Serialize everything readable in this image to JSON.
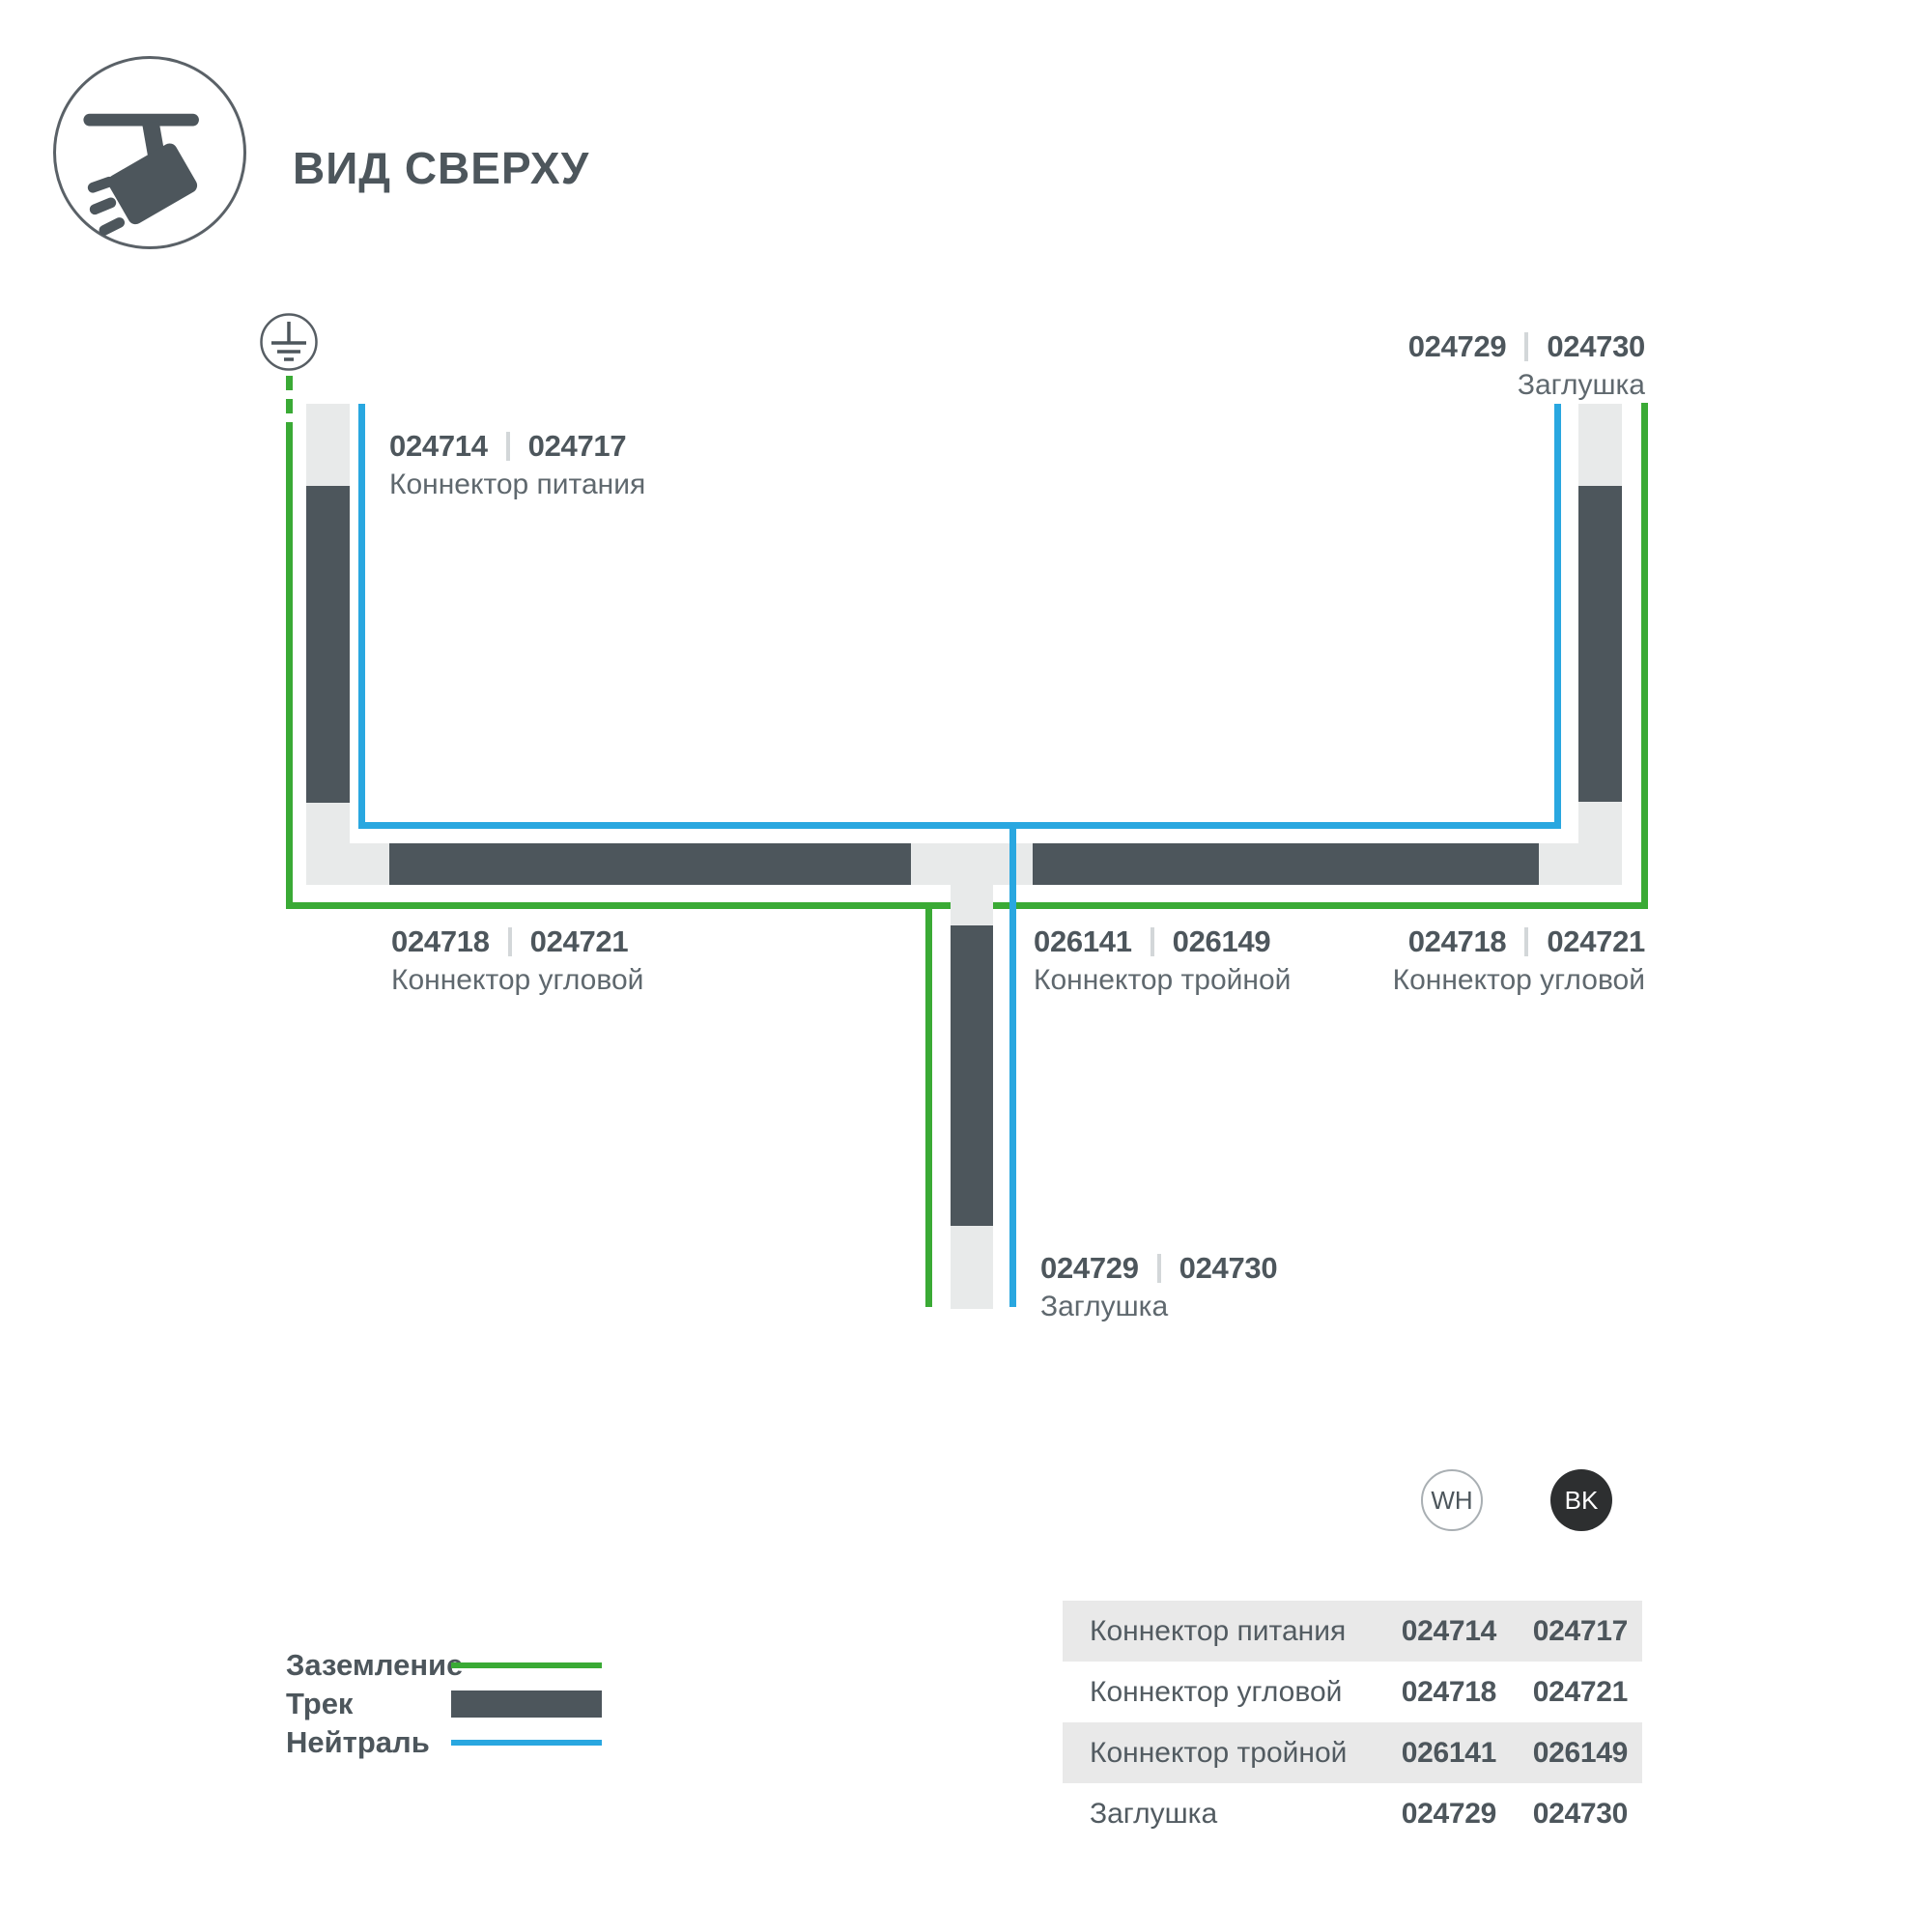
{
  "header": {
    "title": "ВИД СВЕРХУ",
    "icon": "track-spotlight-icon"
  },
  "colors": {
    "ground_green": "#3aaa35",
    "neutral_blue": "#29a7e0",
    "track_dark": "#4d565c",
    "track_light": "#e8eaea",
    "table_row_band": "#e9e9e9"
  },
  "diagram": {
    "ground_symbol_icon": "earth-ground-icon",
    "labels": {
      "power": {
        "code_a": "024714",
        "code_b": "024717",
        "name": "Коннектор питания"
      },
      "endcap_top": {
        "code_a": "024729",
        "code_b": "024730",
        "name": "Заглушка"
      },
      "corner_left": {
        "code_a": "024718",
        "code_b": "024721",
        "name": "Коннектор угловой"
      },
      "triple": {
        "code_a": "026141",
        "code_b": "026149",
        "name": "Коннектор тройной"
      },
      "corner_right": {
        "code_a": "024718",
        "code_b": "024721",
        "name": "Коннектор угловой"
      },
      "endcap_bottom": {
        "code_a": "024729",
        "code_b": "024730",
        "name": "Заглушка"
      }
    }
  },
  "legend": {
    "items": [
      {
        "label": "Заземление",
        "swatch": "green-line"
      },
      {
        "label": "Трек",
        "swatch": "track-bar"
      },
      {
        "label": "Нейтраль",
        "swatch": "blue-line"
      }
    ]
  },
  "variants": {
    "white": "WH",
    "black": "BK"
  },
  "table": {
    "rows": [
      {
        "name": "Коннектор питания",
        "wh": "024714",
        "bk": "024717"
      },
      {
        "name": "Коннектор угловой",
        "wh": "024718",
        "bk": "024721"
      },
      {
        "name": "Коннектор тройной",
        "wh": "026141",
        "bk": "026149"
      },
      {
        "name": "Заглушка",
        "wh": "024729",
        "bk": "024730"
      }
    ]
  }
}
